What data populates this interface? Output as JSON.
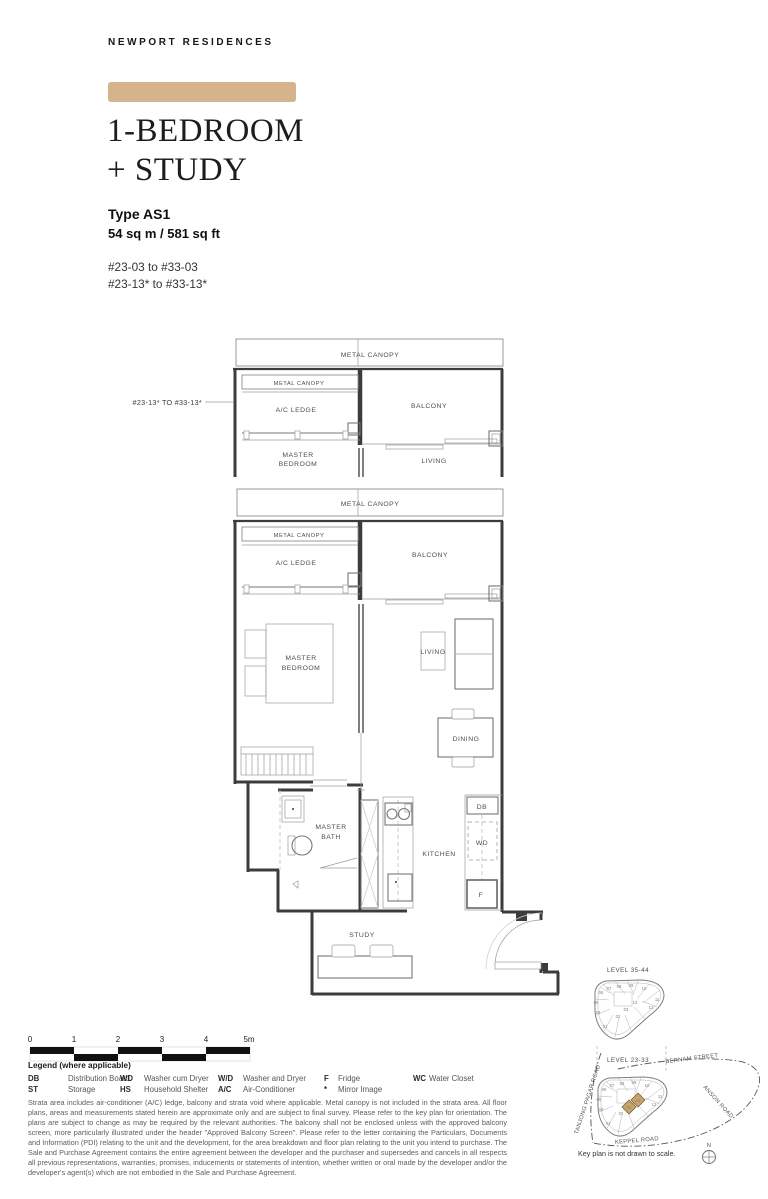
{
  "brand": "NEWPORT RESIDENCES",
  "accent_color": "#d5b48d",
  "title": {
    "line1": "1-BEDROOM",
    "line2": "+ STUDY"
  },
  "unit": {
    "type_label": "Type AS1",
    "area": "54 sq m / 581 sq ft",
    "stack_range_1": "#23-03 to #33-03",
    "stack_range_2": "#23-13* to #33-13*"
  },
  "partial_plan": {
    "stack_label": "#23-13* TO #33-13*"
  },
  "plan_labels": {
    "metal_canopy": "METAL CANOPY",
    "ac_ledge": "A/C LEDGE",
    "balcony": "BALCONY",
    "master_bedroom_line1": "MASTER",
    "master_bedroom_line2": "BEDROOM",
    "living": "LIVING",
    "dining": "DINING",
    "kitchen": "KITCHEN",
    "master_bath_line1": "MASTER",
    "master_bath_line2": "BATH",
    "study": "STUDY",
    "db": "DB",
    "wd": "WD",
    "f": "F"
  },
  "scale_bar": {
    "ticks": [
      "0",
      "1",
      "2",
      "3",
      "4",
      "5m"
    ]
  },
  "legend": {
    "header": "Legend (where applicable)",
    "entries": [
      {
        "abbr": "DB",
        "label": "Distribution Board"
      },
      {
        "abbr": "ST",
        "label": "Storage"
      },
      {
        "abbr": "WD",
        "label": "Washer cum Dryer"
      },
      {
        "abbr": "HS",
        "label": "Household Shelter"
      },
      {
        "abbr": "W/D",
        "label": "Washer and Dryer"
      },
      {
        "abbr": "A/C",
        "label": "Air-Conditioner"
      },
      {
        "abbr": "F",
        "label": "Fridge"
      },
      {
        "abbr": "*",
        "label": "Mirror Image"
      },
      {
        "abbr": "WC",
        "label": "Water Closet"
      }
    ]
  },
  "disclaimer": "Strata area includes air-conditioner (A/C) ledge, balcony and strata void where applicable. Metal canopy is not included in the strata area. All floor plans, areas and measurements stated herein are approximate only and are subject to final survey. Please refer to the key plan for orientation. The plans are subject to change as may be required by the relevant authorities. The balcony shall not be enclosed unless with the approved balcony screen, more particularly illustrated under the header \"Approved Balcony Screen\". Please refer to the letter containing the Particulars, Documents and Information (PDI) relating to the unit and the development, for the area breakdown and floor plan relating to the unit you intend to purchase. The Sale and Purchase Agreement contains the entire agreement between the developer and the purchaser and supersedes and cancels in all respects all previous representations, warranties, promises, inducements or statements of intention, whether written or oral made by the developer and/or the developer's agent(s) which are not embodied in the Sale and Purchase Agreement.",
  "key_plan": {
    "upper_level_label": "LEVEL 35-44",
    "lower_level_label": "LEVEL 23-33",
    "streets": {
      "bernam": "BERNAM STREET",
      "tanjong_pagar": "TANJONG PAGAR ROAD",
      "anson": "ANSON ROAD",
      "keppel": "KEPPEL ROAD"
    },
    "north_label": "N",
    "note": "Key plan is not drawn to scale.",
    "highlight_color": "#c9a468",
    "highlighted_units": [
      "03",
      "13"
    ],
    "unit_numbers": [
      "01",
      "02",
      "03",
      "04",
      "05",
      "06",
      "07",
      "08",
      "09",
      "10",
      "11",
      "12",
      "13"
    ]
  }
}
